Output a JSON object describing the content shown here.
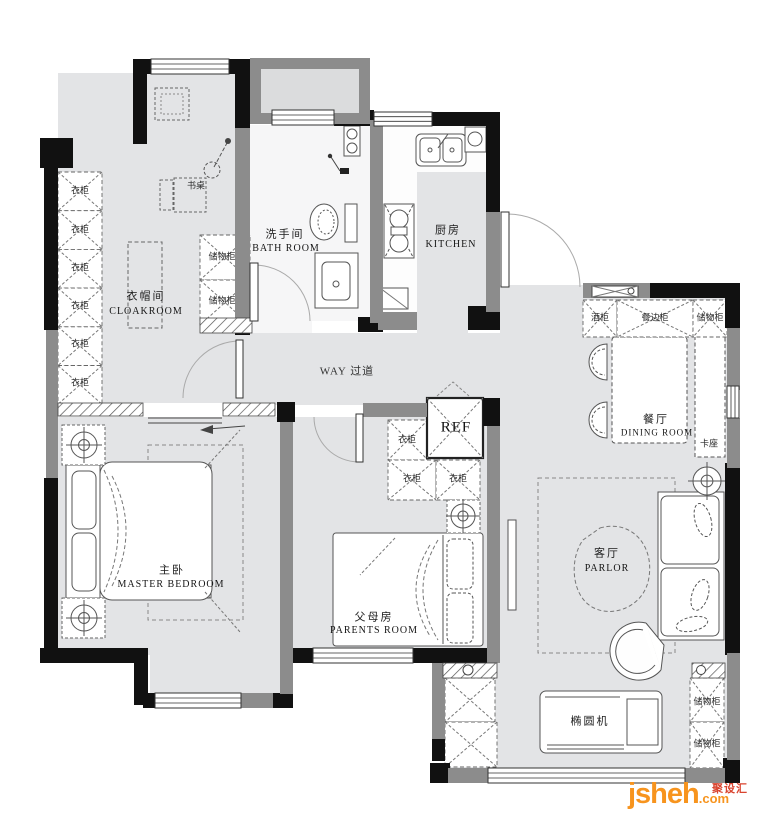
{
  "rooms": {
    "cloakroom_cn": "衣帽间",
    "cloakroom_en": "CLOAKROOM",
    "bathroom_cn": "洗手间",
    "bathroom_en": "BATH ROOM",
    "kitchen_cn": "厨房",
    "kitchen_en": "KITCHEN",
    "corridor": "WAY 过道",
    "dining_cn": "餐厅",
    "dining_en": "DINING ROOM",
    "master_cn": "主卧",
    "master_en": "MASTER BEDROOM",
    "parents_cn": "父母房",
    "parents_en": "PARENTS ROOM",
    "parlor_cn": "客厅",
    "parlor_en": "PARLOR"
  },
  "furniture": {
    "desk": "书桌",
    "wardrobe": "衣柜",
    "storage_cabinet": "储物柜",
    "wine_cabinet": "酒柜",
    "sideboard": "餐边柜",
    "booth_seat": "卡座",
    "fridge": "REF",
    "elliptical_machine": "椭圆机"
  },
  "watermark": {
    "brand": "jsheh",
    "tld": ".com",
    "cn": "聚设汇"
  },
  "colors": {
    "floor": "#e3e4e6",
    "bath_floor": "#f6f6f7",
    "wall_black": "#111111",
    "wall_gray": "#8c8c8c",
    "watermark_orange": "#f7941e",
    "watermark_red": "#d9442f"
  }
}
